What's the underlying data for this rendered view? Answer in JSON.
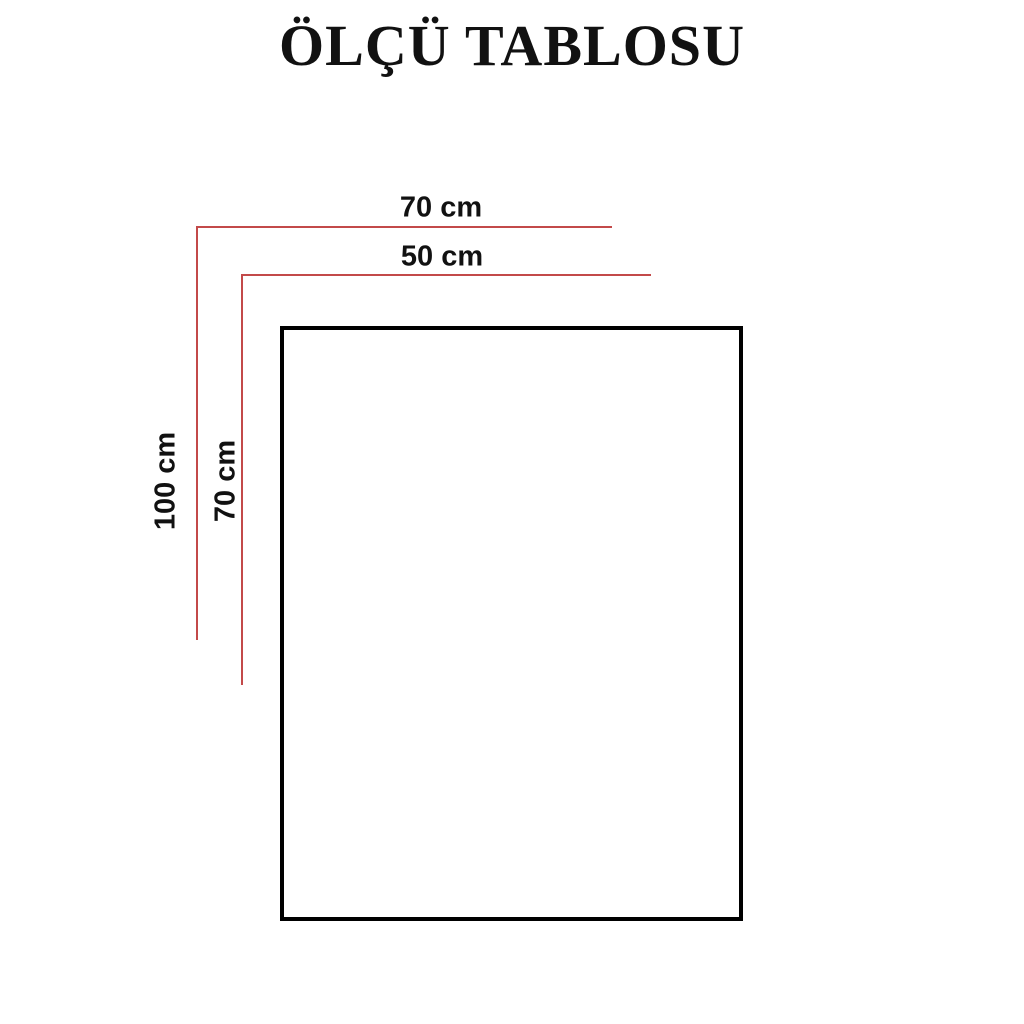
{
  "title": "ÖLÇÜ TABLOSU",
  "diagram": {
    "type": "size-chart",
    "labels": {
      "outer_width": "70 cm",
      "inner_width": "50 cm",
      "outer_height": "100 cm",
      "inner_height": "70 cm"
    }
  },
  "colors": {
    "dimension-line": "#c34a4a",
    "shape-border": "#000000",
    "label-text": "#111111",
    "background": "#ffffff"
  }
}
